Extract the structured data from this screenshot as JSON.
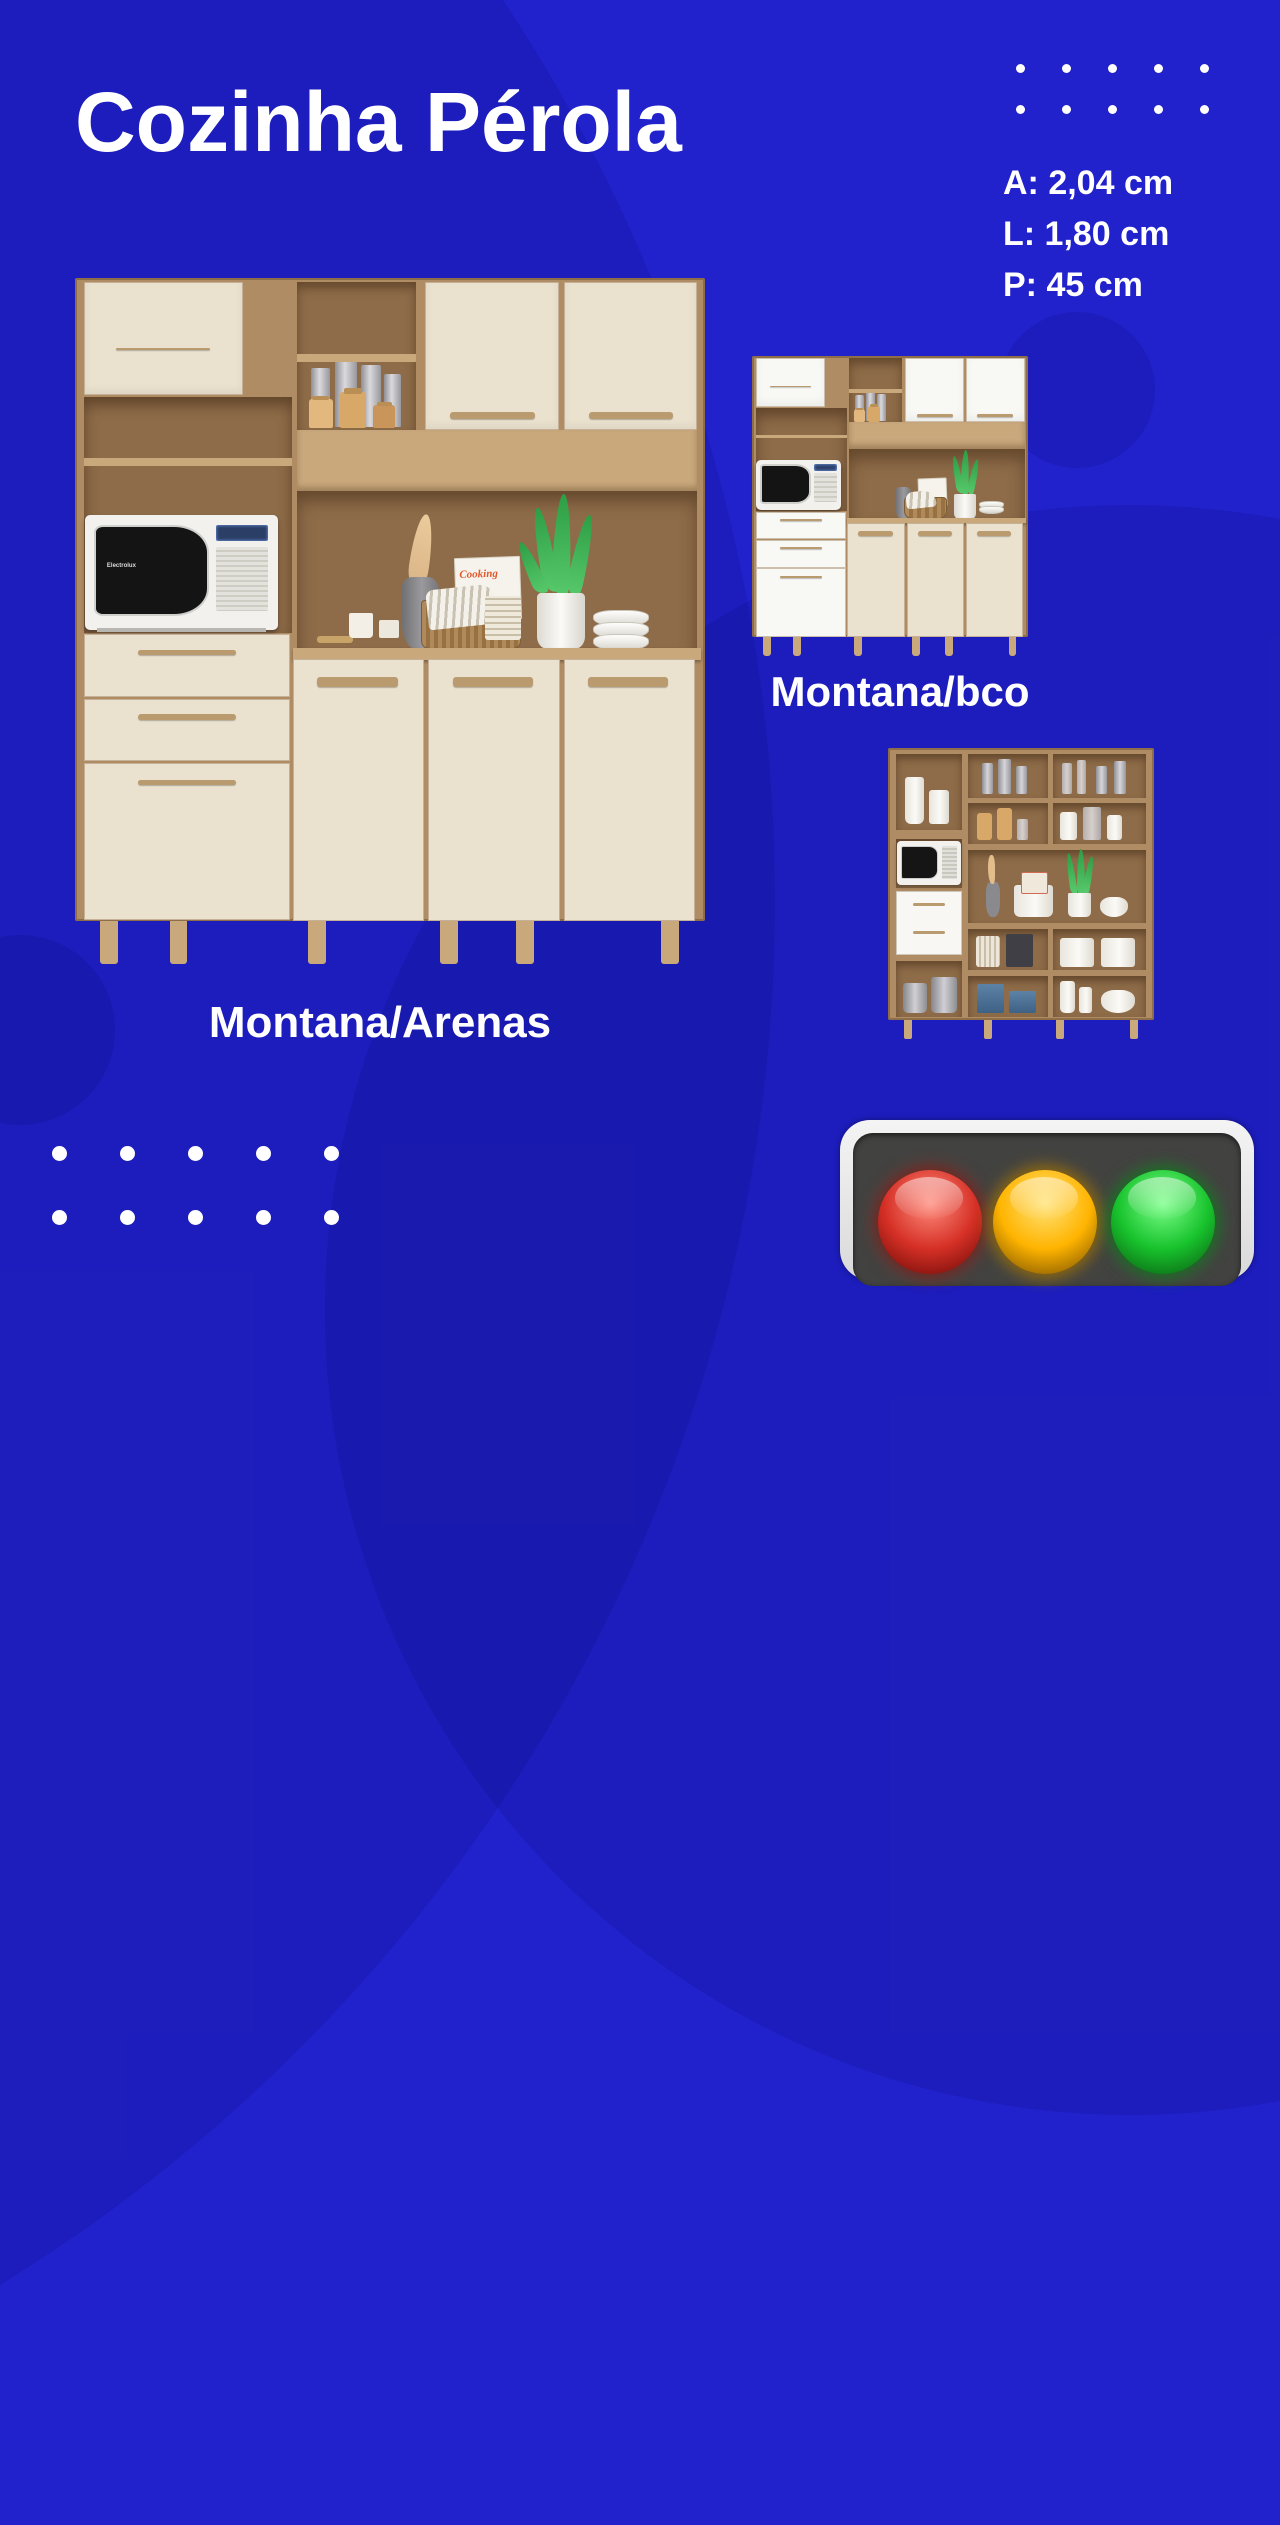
{
  "title": "Cozinha Pérola",
  "specs": [
    "A: 2,04 cm",
    "L: 1,80 cm",
    "P: 45 cm"
  ],
  "products": [
    {
      "id": "montana-arenas",
      "label": "Montana/Arenas",
      "door_color": "#EAE1CE"
    },
    {
      "id": "montana-bco",
      "label": "Montana/bco",
      "door_color": "#F8F8F5"
    },
    {
      "id": "montana-open",
      "label": ""
    }
  ],
  "decor": {
    "book_title": "Cooking",
    "microwave_brand": "Electrolux"
  },
  "traffic_light": {
    "lights": [
      {
        "name": "red",
        "color": "#D63026",
        "highlight": "#FF8D7E",
        "shadow": "#6E0B07"
      },
      {
        "name": "yellow",
        "color": "#FFB400",
        "highlight": "#FFE37A",
        "shadow": "#7A5200"
      },
      {
        "name": "green",
        "color": "#18C32D",
        "highlight": "#7DFF8A",
        "shadow": "#0A5E12"
      }
    ]
  },
  "colors": {
    "background": "#2122CB",
    "wood": "#B08C64",
    "wood_dark": "#8E6C49",
    "wood_light": "#C9A87C",
    "handle": "#BA9A6F",
    "door_arenas": "#EAE1CE",
    "door_bco": "#F8F8F5",
    "text": "#FFFFFF"
  }
}
